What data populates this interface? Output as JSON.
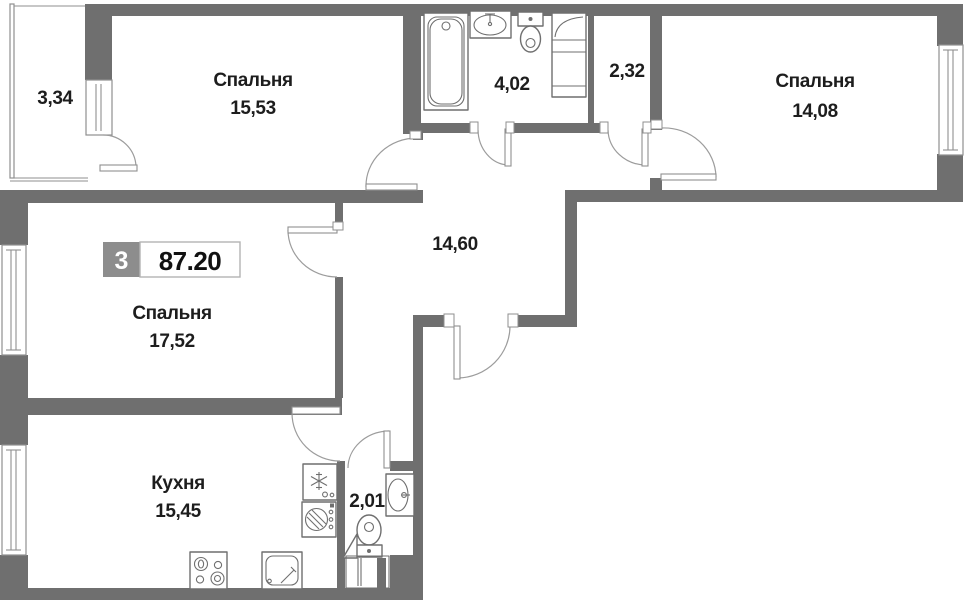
{
  "plan": {
    "badge": {
      "rooms": "3",
      "area": "87.20"
    },
    "rooms": [
      {
        "id": "bedroom-top-left",
        "name": "Спальня",
        "area": "15,53"
      },
      {
        "id": "balcony",
        "name": "",
        "area": "3,34"
      },
      {
        "id": "bathroom",
        "name": "",
        "area": "4,02"
      },
      {
        "id": "wc",
        "name": "",
        "area": "2,32"
      },
      {
        "id": "bedroom-top-right",
        "name": "Спальня",
        "area": "14,08"
      },
      {
        "id": "bedroom-left",
        "name": "Спальня",
        "area": "17,52"
      },
      {
        "id": "hallway",
        "name": "",
        "area": "14,60"
      },
      {
        "id": "kitchen",
        "name": "Кухня",
        "area": "15,45"
      },
      {
        "id": "bathroom-small",
        "name": "",
        "area": "2,01"
      }
    ],
    "icons": {
      "bathtub": "rounded-rect-with-drain",
      "washbasin": "oval-with-tap",
      "toilet": "tank-and-bowl",
      "utility-cabinet": "rect-with-curve",
      "fridge": "snowflake",
      "washing-machine": "hatched-drum",
      "stove": "four-burners",
      "kitchen-sink": "rounded-square-with-tap",
      "vent-shaft": "barred-duct",
      "corner-shelf": "triangle"
    },
    "colors": {
      "wall": "#6f6f6f",
      "line": "#8f8f8f",
      "text": "#1d1d1d",
      "badge_bg": "#8d8d8d",
      "badge_text": "#ffffff",
      "area_box_border": "#b3b3b3"
    }
  }
}
